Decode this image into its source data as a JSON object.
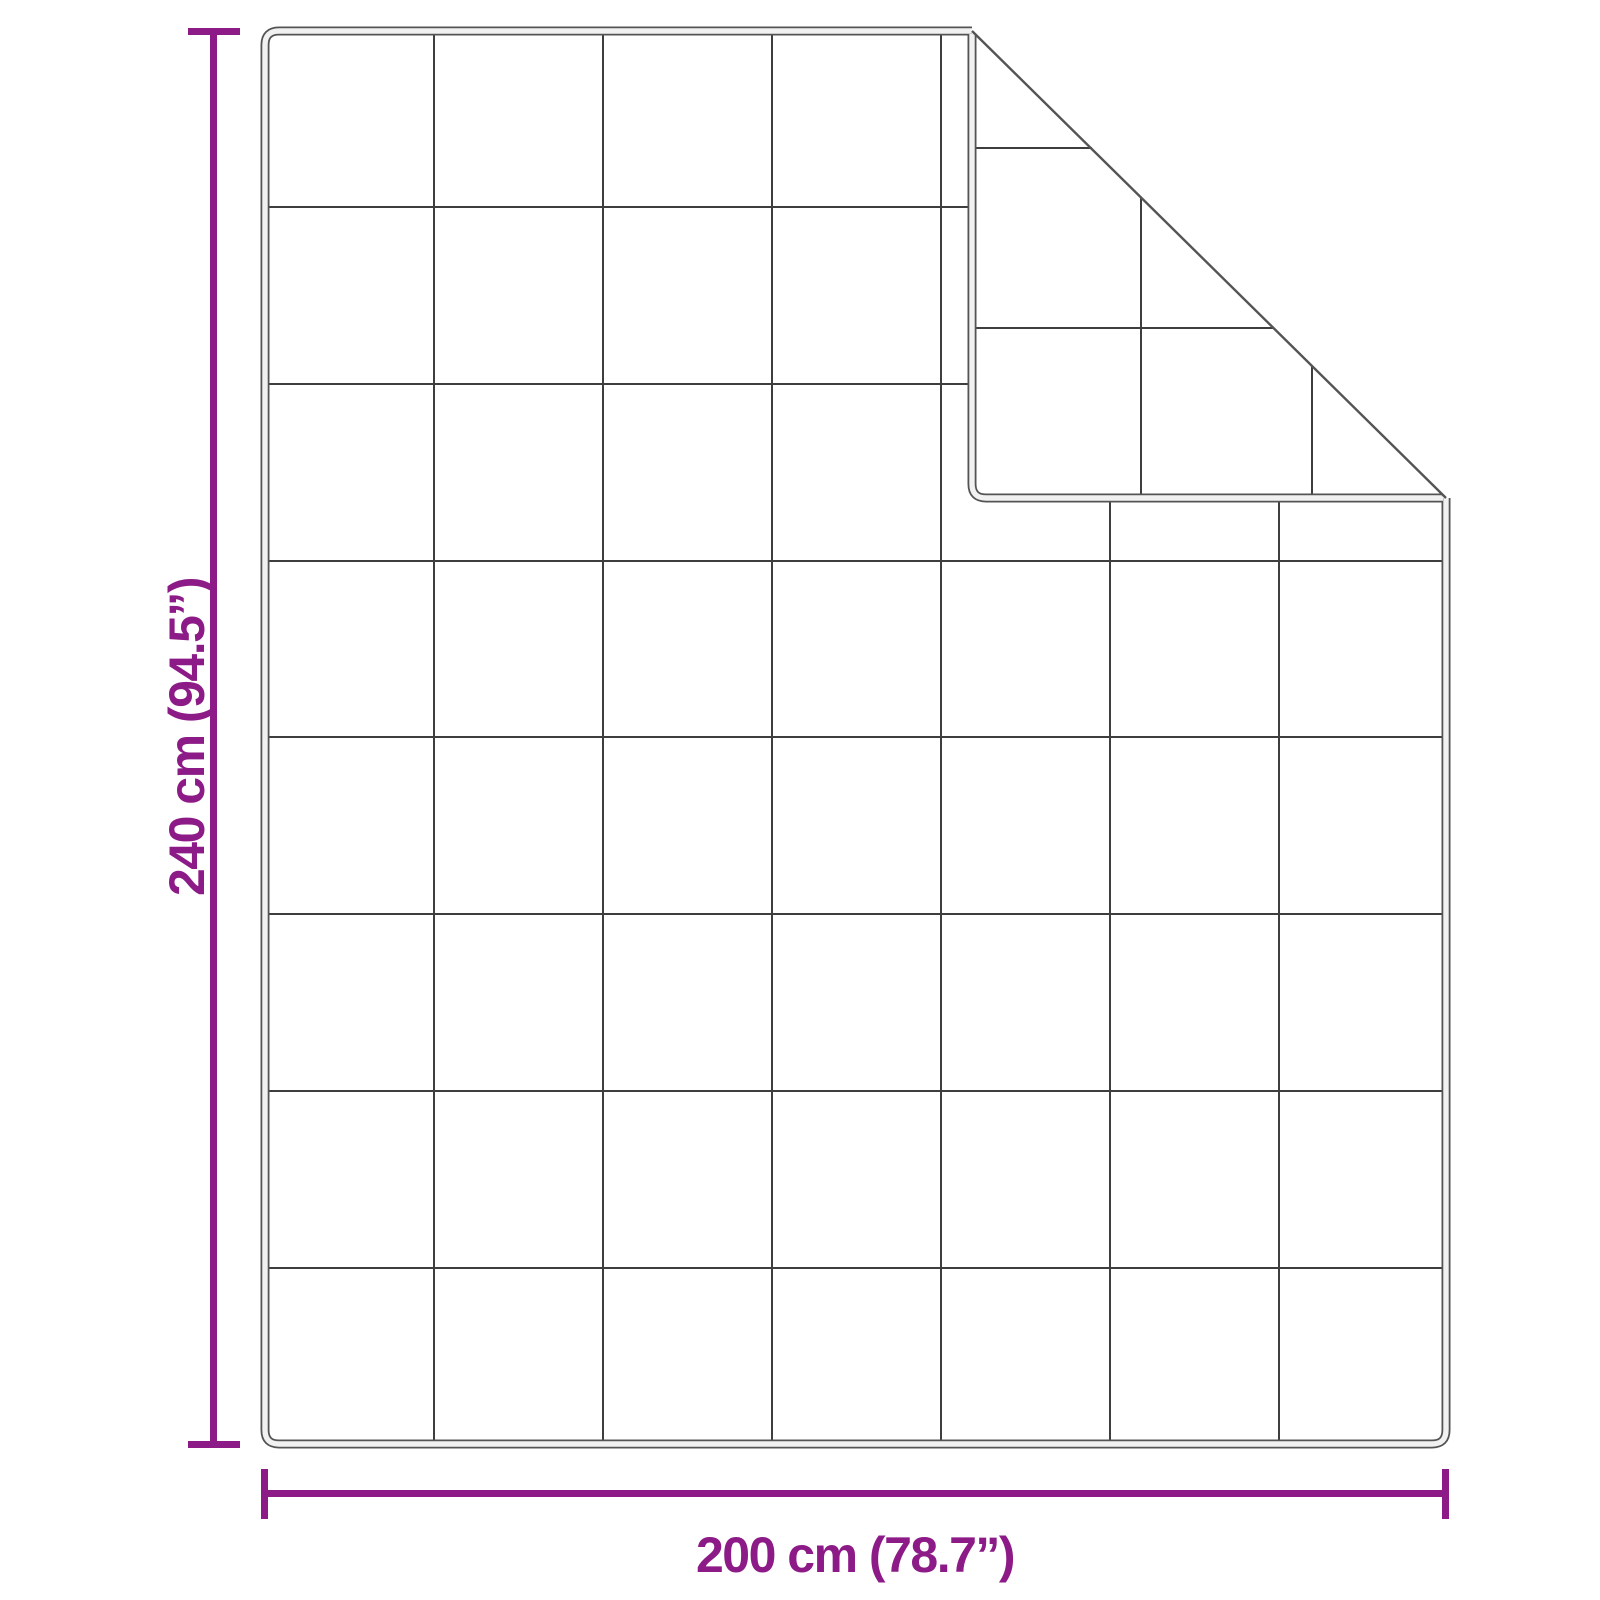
{
  "figure": {
    "kind": "blanket-dimension-diagram",
    "description": "Quilted blanket shown flat with top-right corner folded over"
  },
  "dimensions": {
    "height_label": "240 cm (94.5”)",
    "width_label": "200 cm (78.7”)"
  },
  "blanket": {
    "grid_columns": 7,
    "grid_rows": 8,
    "flap_horizontal_lines": 2,
    "flap_vertical_lines": 2
  },
  "colors": {
    "accent": "#8D1B87",
    "grid_line": "#3E3E3E",
    "edge_dark": "#545454",
    "edge_light": "#F1F1F1",
    "surface": "#FFFFFF"
  }
}
